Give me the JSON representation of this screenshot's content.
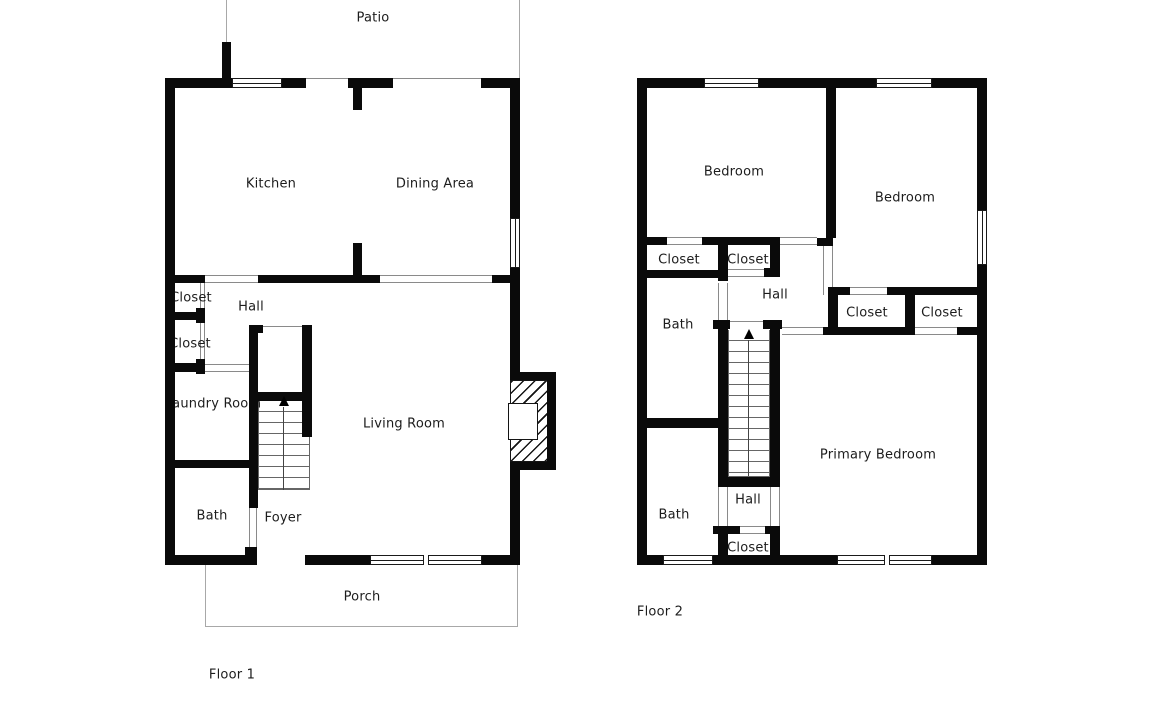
{
  "colors": {
    "wall": "#0a0a0a",
    "opening_line": "#8a8a8a",
    "outdoor_outline": "#a8a8a8",
    "window_border": "#1a1a1a",
    "text": "#1c1c1c",
    "background": "#ffffff"
  },
  "floor1": {
    "label": "Floor 1",
    "rooms": {
      "patio": "Patio",
      "kitchen": "Kitchen",
      "dining": "Dining Area",
      "closet_upper": "Closet",
      "hall": "Hall",
      "closet_lower": "Closet",
      "laundry": "Laundry Room",
      "living": "Living Room",
      "bath": "Bath",
      "foyer": "Foyer",
      "porch": "Porch"
    }
  },
  "floor2": {
    "label": "Floor 2",
    "rooms": {
      "bedroom_left": "Bedroom",
      "bedroom_right": "Bedroom",
      "closet_bedroom_left": "Closet",
      "closet_hall_upper": "Closet",
      "hall_upper": "Hall",
      "bath_upper": "Bath",
      "closet_bedroom_right": "Closet",
      "closet_primary": "Closet",
      "primary_bedroom": "Primary Bedroom",
      "hall_lower": "Hall",
      "bath_lower": "Bath",
      "closet_hall_lower": "Closet"
    }
  }
}
